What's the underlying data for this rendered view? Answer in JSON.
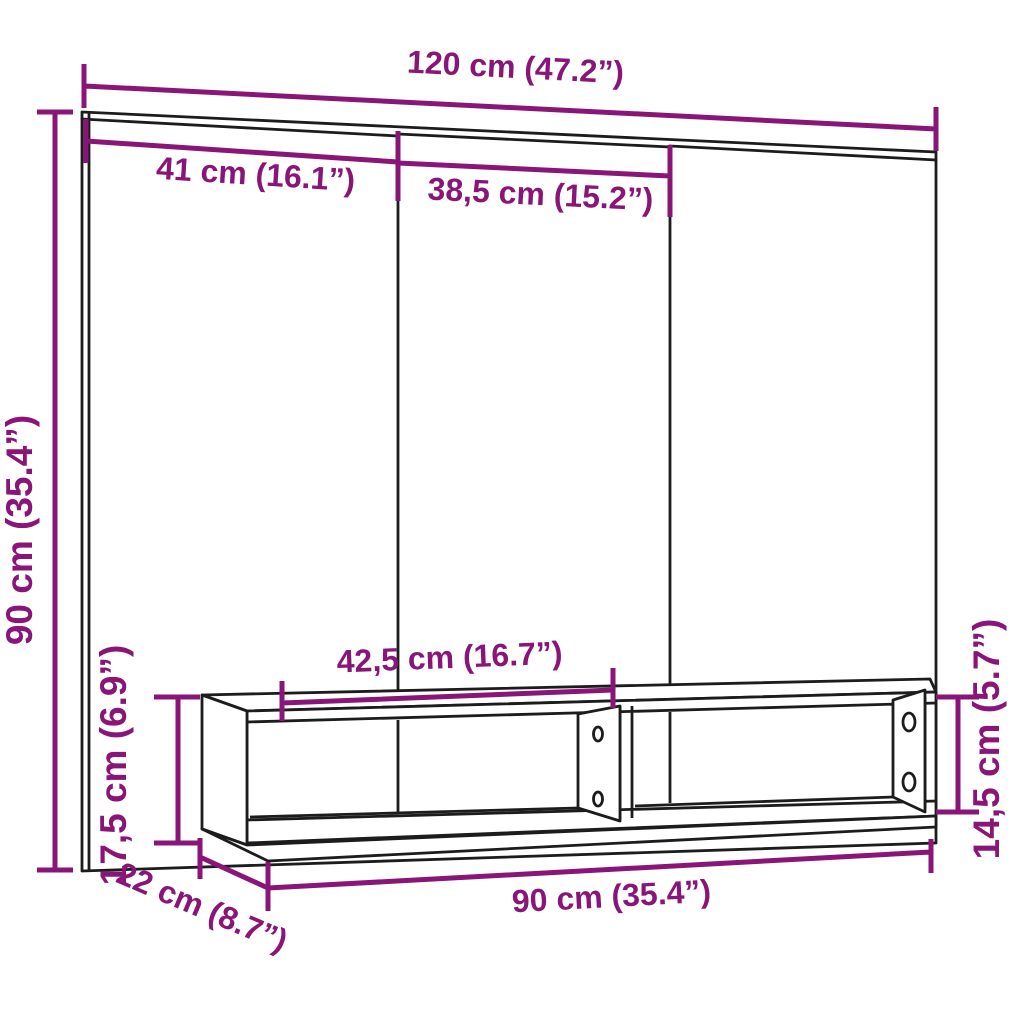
{
  "diagram": {
    "title": "wall-mounted tv unit dimension diagram",
    "background": "#ffffff",
    "line_color": "#1c1c1c",
    "dimension_color": "#8A1578",
    "dimensions": {
      "total_width": {
        "label": "120 cm (47.2”)"
      },
      "left_section_width": {
        "label": "41 cm (16.1”)"
      },
      "middle_section_width": {
        "label": "38,5 cm (15.2”)"
      },
      "total_height": {
        "label": "90 cm (35.4”)"
      },
      "shelf_compartment_width": {
        "label": "42,5 cm (16.7”)"
      },
      "shelf_outer_height": {
        "label": "17,5 cm (6.9”)"
      },
      "shelf_inner_height": {
        "label": "14,5 cm (5.7”)"
      },
      "shelf_width": {
        "label": "90 cm (35.4”)"
      },
      "shelf_depth": {
        "label": "22 cm (8.7”)"
      }
    }
  }
}
